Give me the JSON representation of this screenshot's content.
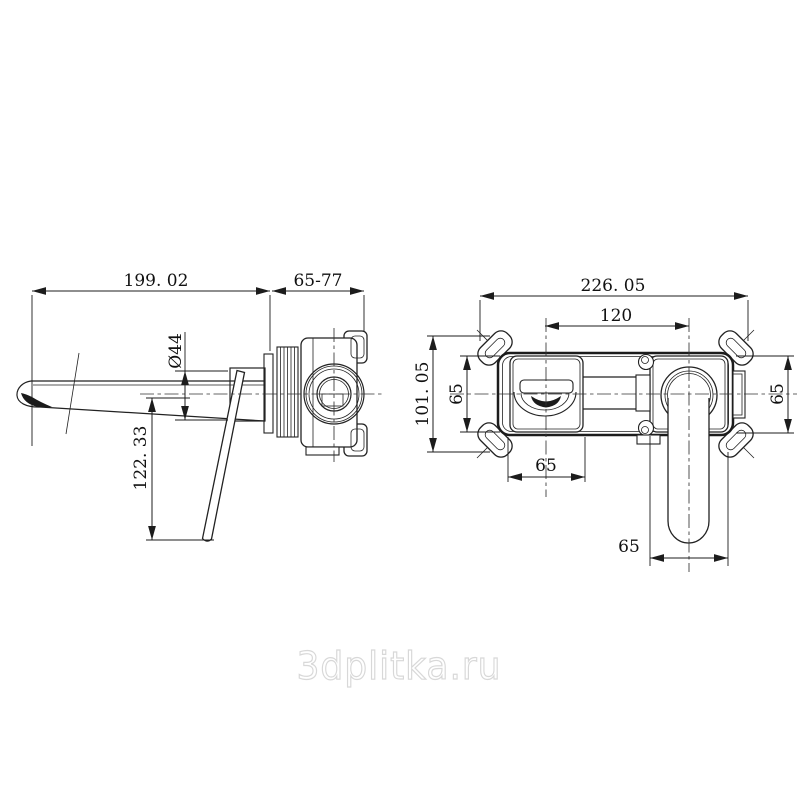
{
  "watermark": {
    "text": "3dplitka.ru"
  },
  "side_view": {
    "dims": {
      "spout_reach": "199. 02",
      "wall_depth": "65-77",
      "spout_diameter": "Ø44",
      "handle_drop": "122. 33"
    }
  },
  "front_view": {
    "dims": {
      "overall_width": "226. 05",
      "spout_to_handle": "120",
      "overall_height": "101. 05",
      "body_height_left": "65",
      "body_height_right": "65",
      "spout_plate_width": "65",
      "handle_plate_width": "65"
    }
  },
  "colors": {
    "line": "#222222",
    "background": "#ffffff",
    "watermark_outline": "#d8d8d8"
  }
}
